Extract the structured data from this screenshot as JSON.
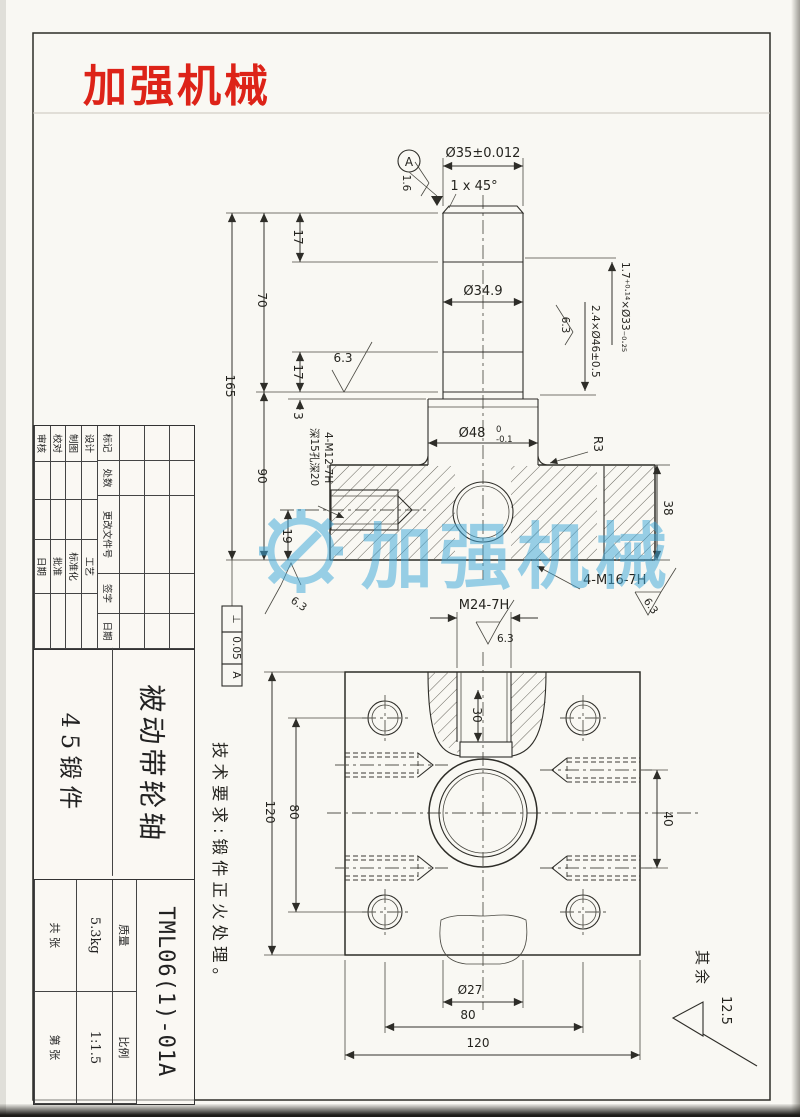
{
  "page": {
    "logo_text": "加强机械",
    "logo_color": "#dd2318"
  },
  "watermark": {
    "text": "加强机械",
    "color": "#3fa8da"
  },
  "notes": {
    "tech_requirements": "技术要求:锻件正火处理。",
    "others_prefix": "其余",
    "others_roughness": "12.5"
  },
  "upper_view": {
    "dia35": "Ø35±0.012",
    "chamfer": "1 x 45°",
    "datum_a": "A",
    "ra16": "1.6",
    "ra63": "6.3",
    "dim17_top": "17",
    "dim70": "70",
    "dim165": "165",
    "dim17_mid": "17",
    "dim3": "3",
    "dim90": "90",
    "dim19": "19",
    "dia349": "Ø34.9",
    "groove_33": "1.7⁺⁰·¹⁴×Ø33₋₀.₂₅",
    "groove_46": "2.4×Ø46±0.5",
    "dia48_main": "Ø48",
    "dia48_upper": "0",
    "dia48_lower": "-0.1",
    "r3": "R3",
    "dim38": "38",
    "m16_label": "4-M16-7H",
    "m12_label": "4-M12-7H",
    "m12_depth": "深15孔深20",
    "perp": {
      "symbol": "⊥",
      "value": "0.05",
      "datum": "A"
    }
  },
  "lower_view": {
    "m24_label": "M24-7H",
    "ra63": "6.3",
    "dim30": "30",
    "dim120_v": "120",
    "dim80_v": "80",
    "dim40": "40",
    "dia27": "Ø27",
    "dim80_h": "80",
    "dim120_h": "120"
  },
  "title_block": {
    "rev_headers": [
      "标记",
      "处数",
      "更改文件号",
      "签字",
      "日期"
    ],
    "row_labels": [
      [
        "设计",
        "工艺"
      ],
      [
        "制图",
        "标准化"
      ],
      [
        "校对",
        "批准"
      ],
      [
        "审核",
        "日期"
      ]
    ],
    "part_name": "被动带轮轴",
    "material": "45锻件",
    "drawing_no": "TML06(1)-01A",
    "mass_label": "质量",
    "scale_label": "比例",
    "mass_value": "5.3kg",
    "scale_value": "1:1.5",
    "sheet_total": "共  张",
    "sheet_no": "第  张"
  }
}
